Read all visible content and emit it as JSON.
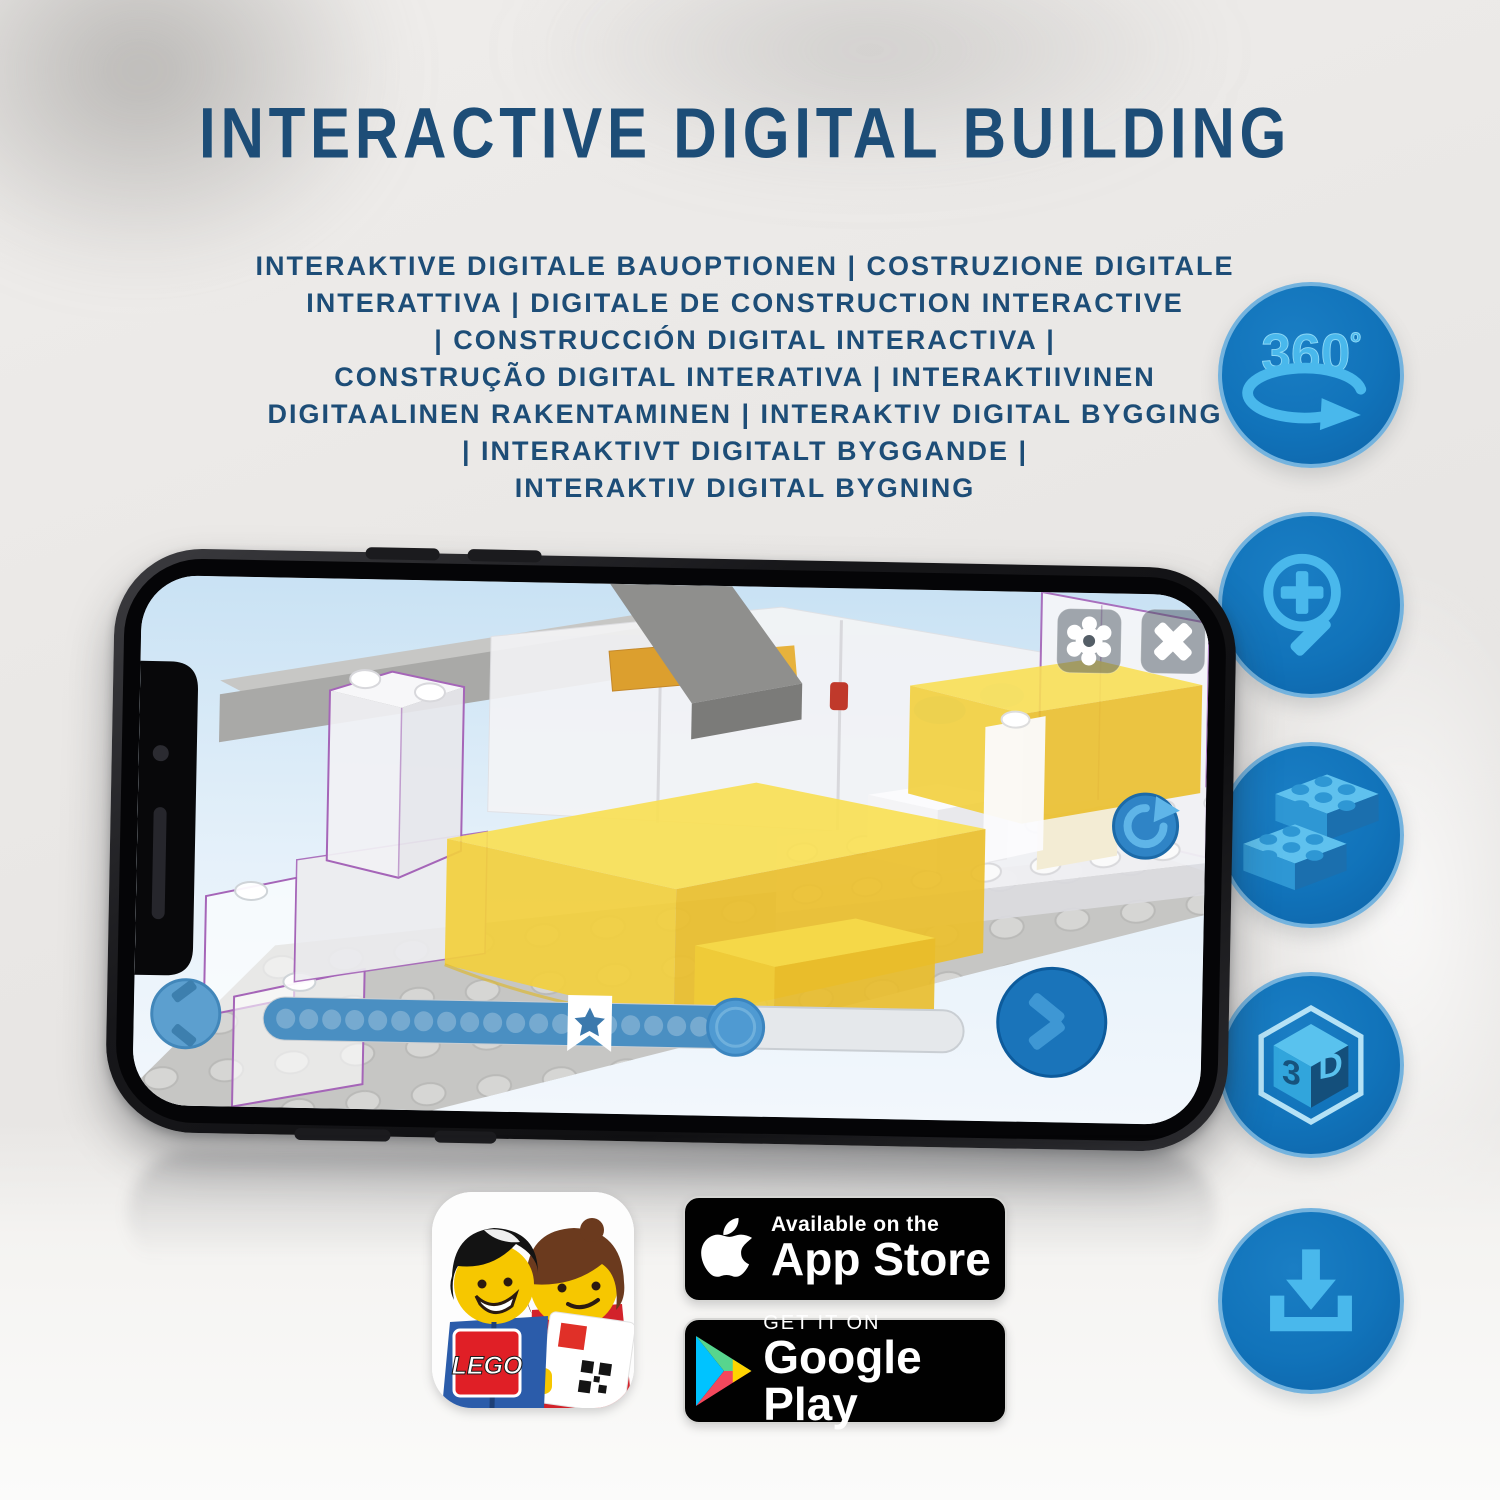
{
  "title": "INTERACTIVE DIGITAL BUILDING",
  "subtitle_lines": [
    "INTERAKTIVE DIGITALE BAUOPTIONEN | COSTRUZIONE DIGITALE",
    "INTERATTIVA | DIGITALE DE CONSTRUCTION INTERACTIVE",
    "| CONSTRUCCIÓN DIGITAL INTERACTIVA |",
    "CONSTRUÇÃO DIGITAL INTERATIVA | INTERAKTIIVINEN",
    "DIGITAALINEN RAKENTAMINEN | INTERAKTIV DIGITAL BYGGING",
    "| INTERAKTIVT DIGITALT BYGGANDE |",
    "INTERAKTIV DIGITAL BYGNING"
  ],
  "feature_icons": {
    "rotation_360": {
      "value": "360",
      "degree": "º"
    },
    "cube_3d": {
      "left": "3",
      "right": "D"
    }
  },
  "app_ui": {
    "depicted_state": {
      "progress_filled_ratio": 0.57,
      "bookmark_ratio": 0.465,
      "dot_count": 20
    }
  },
  "badges": {
    "lego_app": {
      "logo_text": "LEGO"
    },
    "app_store": {
      "top": "Available on the",
      "bottom": "App Store"
    },
    "google_play": {
      "top": "GET IT ON",
      "bottom": "Google Play"
    }
  },
  "colors": {
    "title_navy": "#1d4d77",
    "circle_blue": "#1173ba",
    "circle_border": "#74b3de",
    "glyph_blue": "#49b8ec",
    "brick_yellow": "#f2d33c",
    "ghost_outline_purple": "#a565b8",
    "badge_black": "#010101"
  }
}
